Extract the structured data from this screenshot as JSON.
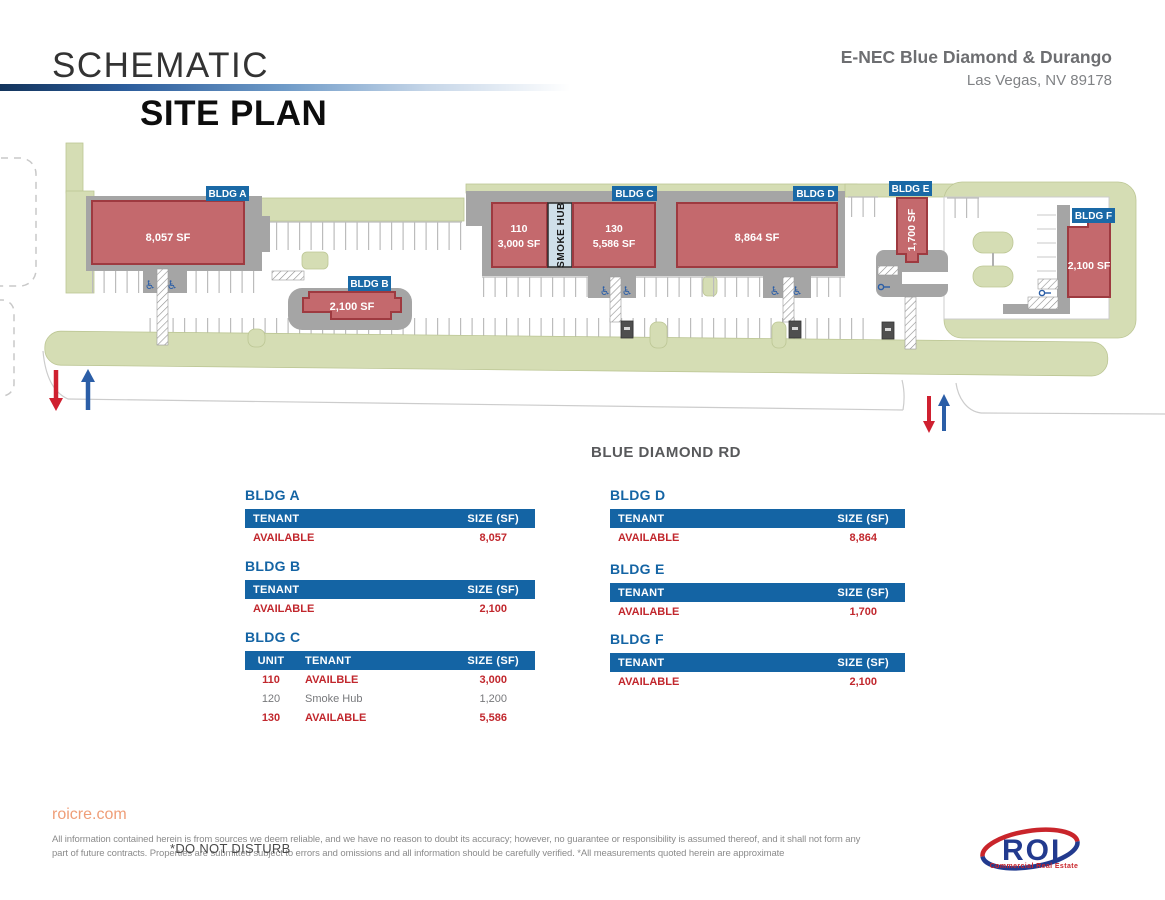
{
  "header": {
    "title_line1": "SCHEMATIC",
    "title_line2": "SITE PLAN",
    "property_name": "E-NEC Blue Diamond & Durango",
    "property_location": "Las Vegas, NV 89178"
  },
  "plan": {
    "road_label": "BLUE DIAMOND RD",
    "buildings": {
      "a": {
        "tag": "BLDG A",
        "size": "8,057 SF"
      },
      "b": {
        "tag": "BLDG B",
        "size": "2,100 SF"
      },
      "c": {
        "tag": "BLDG C",
        "unit110": "110",
        "unit110_size": "3,000 SF",
        "smoke_hub": "SMOKE HUB",
        "unit130": "130",
        "unit130_size": "5,586 SF"
      },
      "d": {
        "tag": "BLDG D",
        "size": "8,864 SF"
      },
      "e": {
        "tag": "BLDG E",
        "size": "1,700 SF"
      },
      "f": {
        "tag": "BLDG F",
        "size": "2,100 SF"
      }
    }
  },
  "tables": {
    "col_unit": "UNIT",
    "col_tenant": "TENANT",
    "col_size": "SIZE (SF)",
    "a": {
      "title": "BLDG A",
      "tenant": "AVAILABLE",
      "size": "8,057"
    },
    "b": {
      "title": "BLDG B",
      "tenant": "AVAILABLE",
      "size": "2,100"
    },
    "c": {
      "title": "BLDG C",
      "rows": [
        {
          "unit": "110",
          "tenant": "AVAILBLE",
          "size": "3,000"
        },
        {
          "unit": "120",
          "tenant": "Smoke Hub",
          "size": "1,200"
        },
        {
          "unit": "130",
          "tenant": "AVAILABLE",
          "size": "5,586"
        }
      ]
    },
    "d": {
      "title": "BLDG D",
      "tenant": "AVAILABLE",
      "size": "8,864"
    },
    "e": {
      "title": "BLDG E",
      "tenant": "AVAILABLE",
      "size": "1,700"
    },
    "f": {
      "title": "BLDG F",
      "tenant": "AVAILABLE",
      "size": "2,100"
    }
  },
  "footer": {
    "website": "roicre.com",
    "disclaimer_line1": "All information contained herein is from sources we deem reliable, and we have no reason to doubt its accuracy; however, no guarantee or responsibility is assumed thereof, and it shall not form any",
    "disclaimer_line2": "part of future contracts. Properties are submitted subject to errors and omissions and all information should be carefully verified. *All measurements quoted herein are approximate",
    "overlay_note": "*DO NOT DISTURB",
    "logo_text": "ROI",
    "logo_subtext": "Commercial Real Estate"
  },
  "colors": {
    "accent_blue": "#1464a4",
    "available_red": "#c1272d",
    "building_fill": "#c4696d",
    "building_border": "#9e3a40",
    "landscape_green": "#d5ddb4",
    "pad_gray": "#a5a5a5",
    "tag_blue": "#1a69a6",
    "arrow_in_blue": "#2b5ea7",
    "arrow_out_red": "#cf2030"
  }
}
